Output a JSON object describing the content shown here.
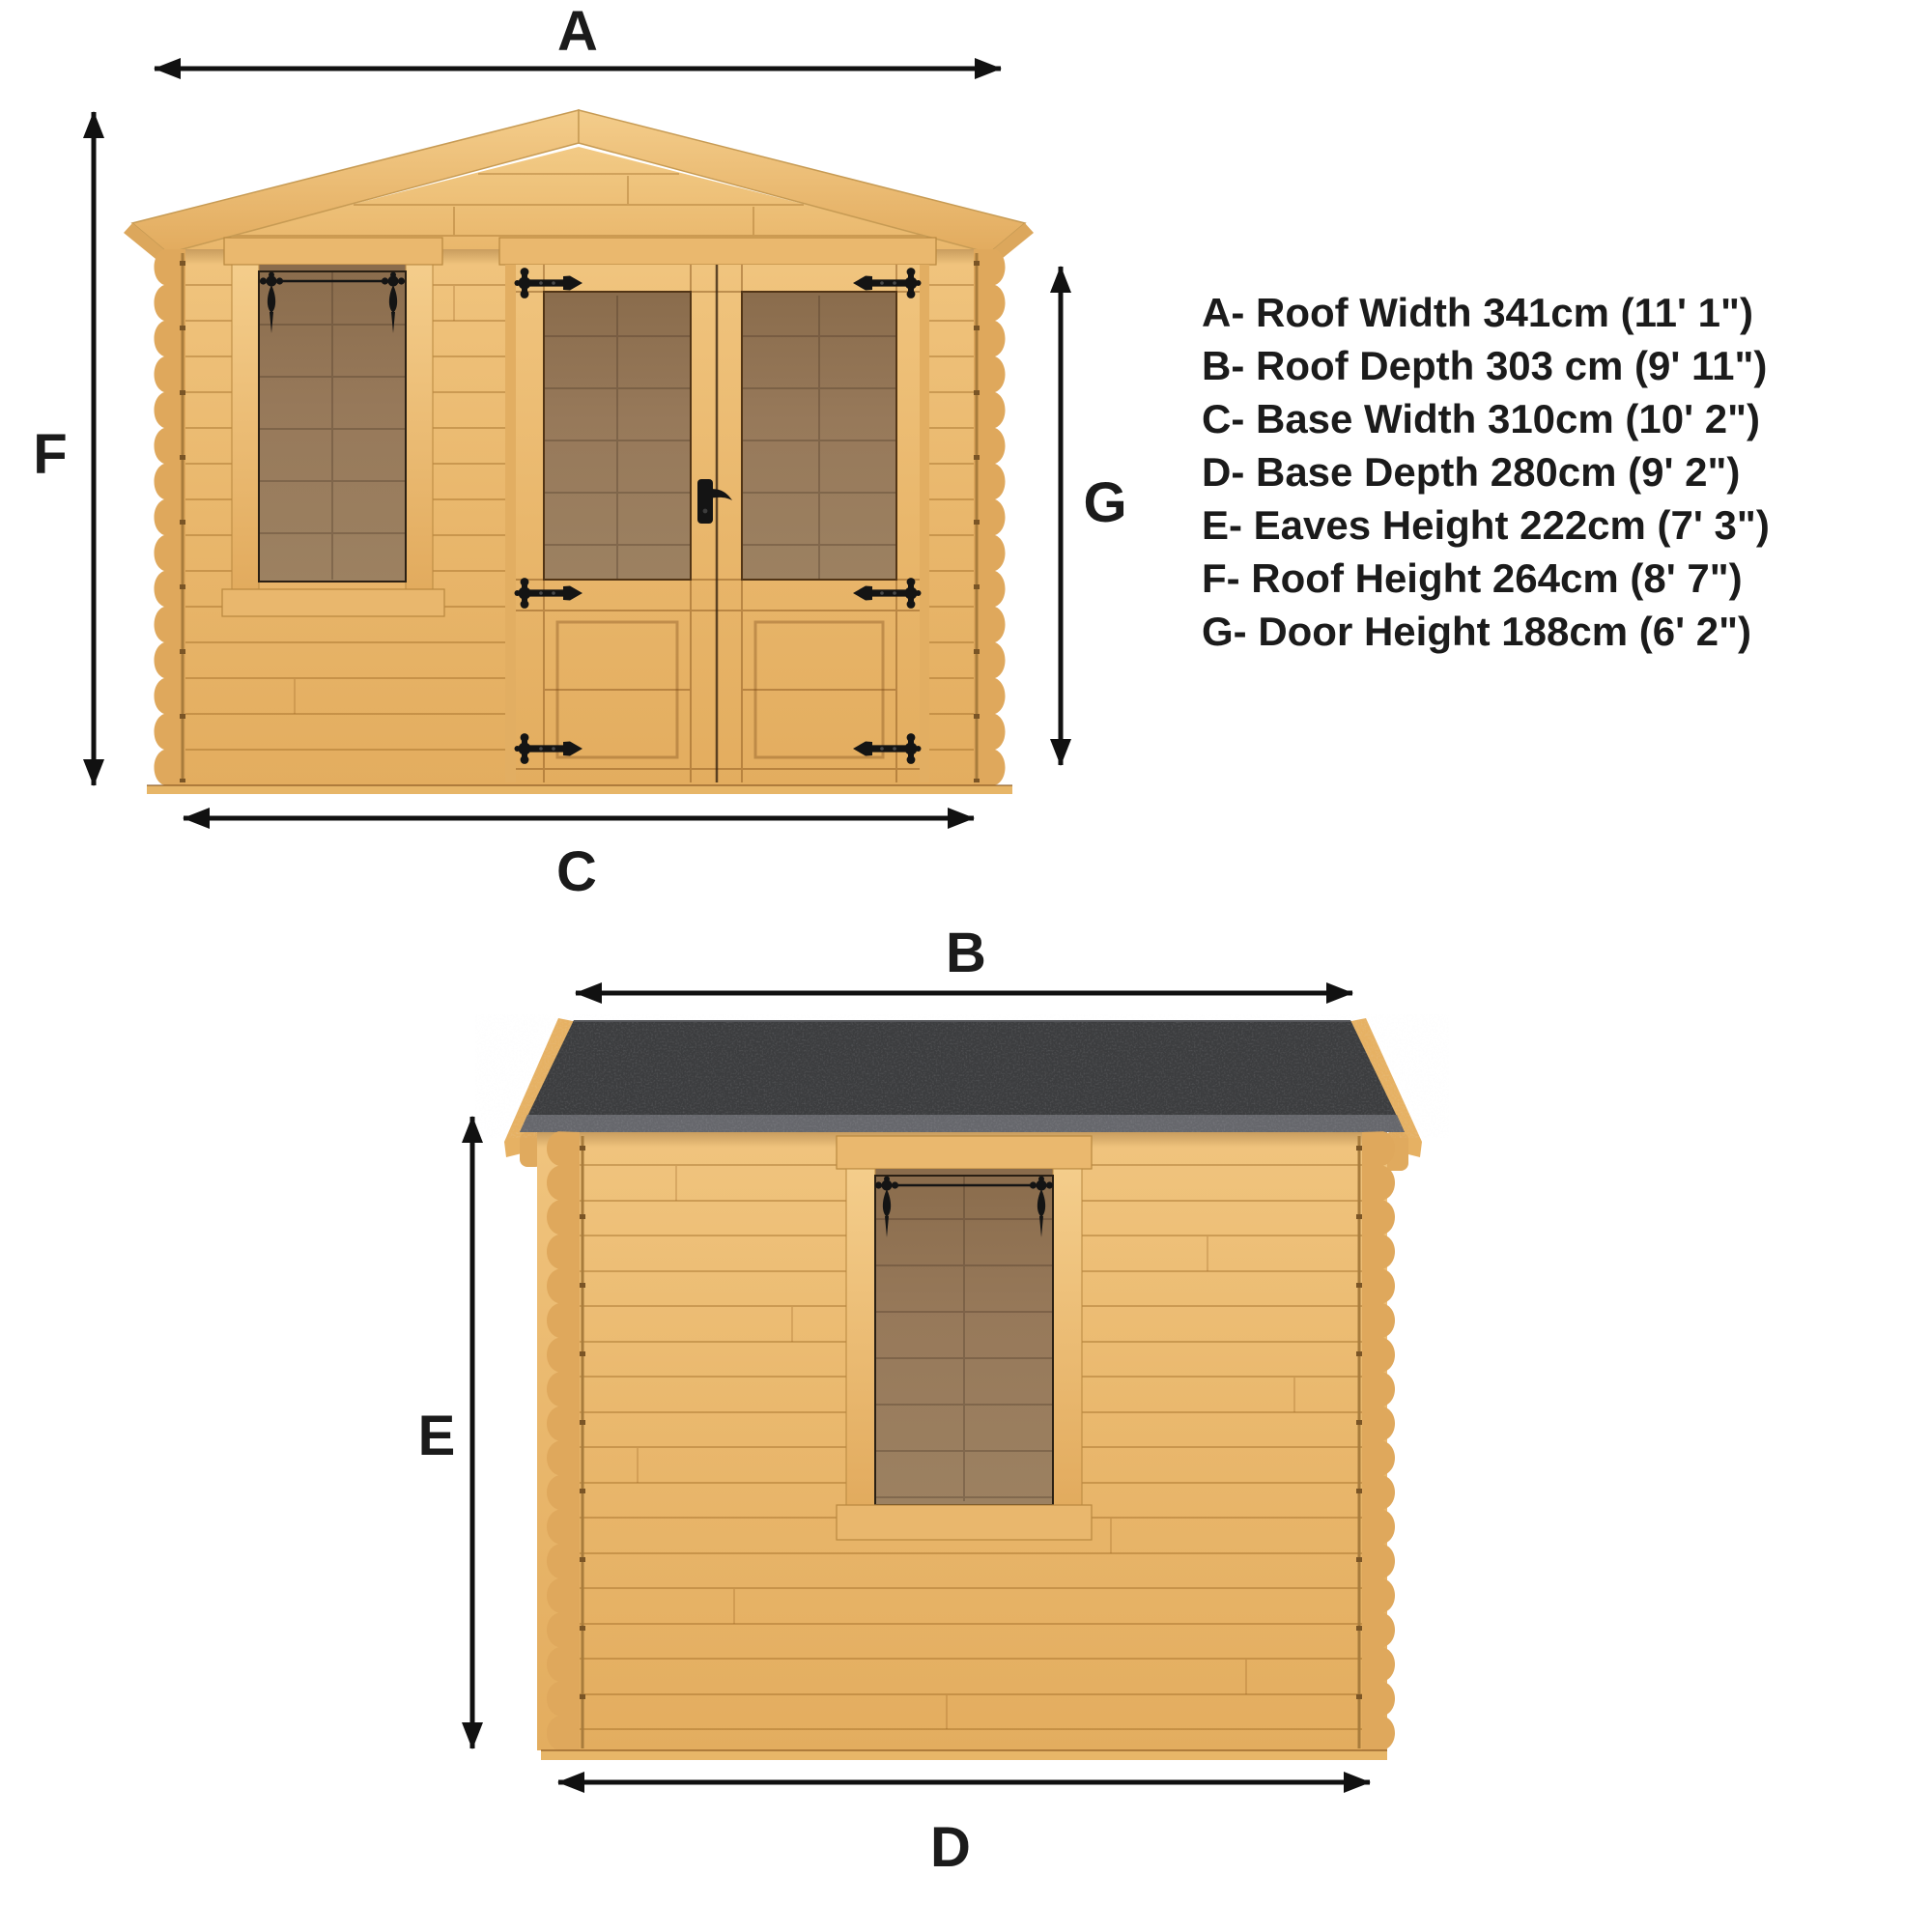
{
  "page": {
    "background": "#ffffff",
    "type": "product-dimension-diagram",
    "subject": "wooden log cabin with apex roof"
  },
  "views": {
    "front": {
      "name": "front-elevation",
      "features": [
        "gable roof",
        "single window with pendant hinges",
        "double glazed doors with t-strap hinges and lever handle"
      ]
    },
    "side": {
      "name": "side-elevation",
      "features": [
        "dark felt flat-pitch roof",
        "single window with pendant hinges",
        "horizontal log cladding"
      ]
    }
  },
  "dims": {
    "a": {
      "letter": "A",
      "name": "Roof Width",
      "metric": "341cm",
      "imperial": "11' 1\"",
      "legend_text": "A- Roof Width 341cm (11' 1\")"
    },
    "b": {
      "letter": "B",
      "name": "Roof Depth",
      "metric": "303 cm",
      "imperial": "9' 11\"",
      "legend_text": "B- Roof Depth 303 cm (9' 11\")"
    },
    "c": {
      "letter": "C",
      "name": "Base Width",
      "metric": "310cm",
      "imperial": "10' 2\"",
      "legend_text": "C- Base Width 310cm (10' 2\")"
    },
    "d": {
      "letter": "D",
      "name": "Base Depth",
      "metric": "280cm",
      "imperial": "9' 2\"",
      "legend_text": "D- Base Depth 280cm (9' 2\")"
    },
    "e": {
      "letter": "E",
      "name": "Eaves Height",
      "metric": "222cm",
      "imperial": "7' 3\"",
      "legend_text": "E- Eaves Height 222cm (7' 3\")"
    },
    "f": {
      "letter": "F",
      "name": "Roof Height",
      "metric": "264cm",
      "imperial": "8' 7\"",
      "legend_text": "F- Roof Height 264cm (8' 7\")"
    },
    "g": {
      "letter": "G",
      "name": "Door Height",
      "metric": "188cm",
      "imperial": "6' 2\"",
      "legend_text": "G- Door Height 188cm (6' 2\")"
    }
  },
  "legend_order": [
    "a",
    "b",
    "c",
    "d",
    "e",
    "f",
    "g"
  ],
  "icons": {
    "dimension_arrow": "double-headed-arrow",
    "door_hinge": "t-strap-hinge",
    "window_hinge": "pendant-hinge",
    "door_handle": "lever-handle"
  },
  "colors": {
    "wood": "#e9b76c",
    "wood_dark": "#d9a55c",
    "wood_light": "#f2cc8a",
    "wood_grain": "#96601e",
    "roof_felt": "#3c3d3f",
    "roof_felt_edge": "#66676c",
    "glass": "#8f7251",
    "hardware_black": "#141414",
    "text": "#1b1b1b"
  }
}
